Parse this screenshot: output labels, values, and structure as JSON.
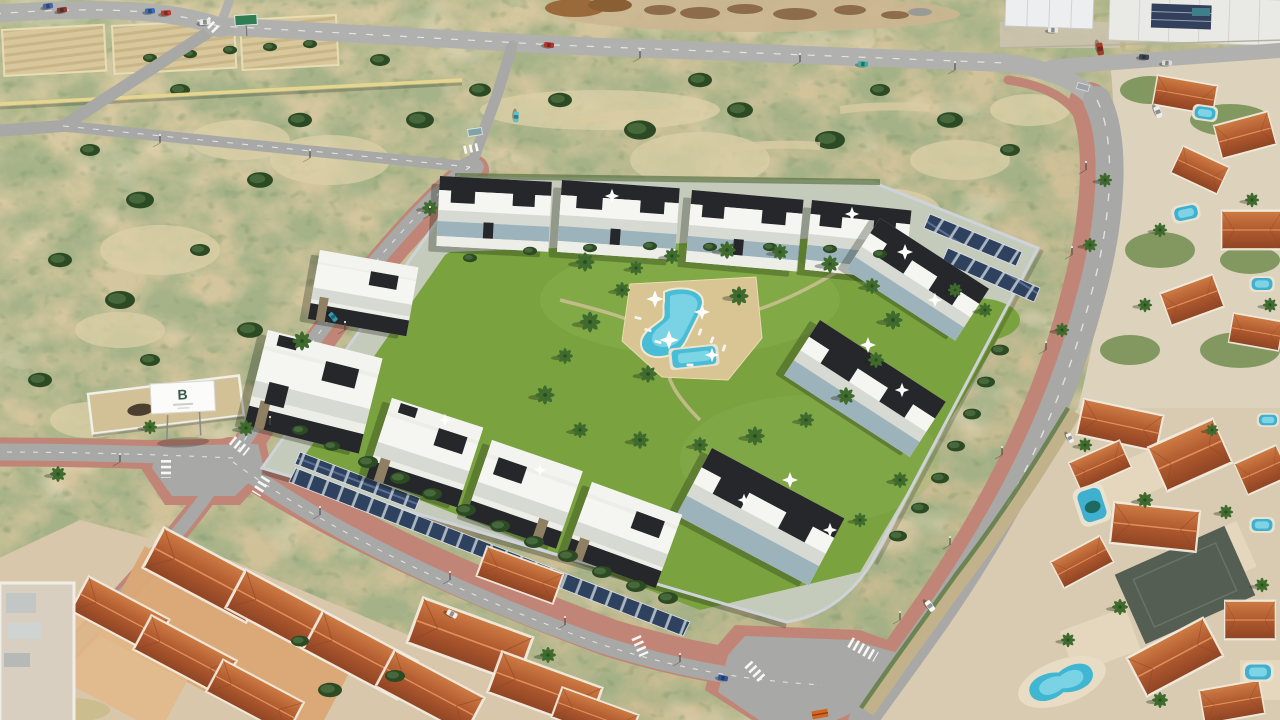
{
  "scene": {
    "type": "aerial-photograph",
    "description": "Aerial render of a modern Mediterranean apartment development with a central landscaped pool garden, bordered by new roads and scrubland plots, an established villa neighbourhood with private pools to the right and bottom-right, terracotta-roofed houses at the bottom-left, and industrial warehouses at the top right.",
    "billboard": {
      "logo_text": "B"
    },
    "palette": {
      "sand": "#d3c49c",
      "scrub_green": "#5d7340",
      "road_asphalt": "#a8a8a6",
      "road_markings": "#ffffff",
      "sidewalk_pink": "#c08577",
      "lawn_green": "#7aa23f",
      "pool_turquoise": "#49bdd6",
      "pool_deck_beige": "#d9c493",
      "building_white": "#edeee8",
      "building_dark": "#25272a",
      "solar_panel_blue": "#2e415f",
      "terracotta_roof": "#b0592f",
      "perimeter_wall_grey": "#cdd3d8",
      "villa_patio_tan": "#dba875"
    },
    "features": {
      "apartment_complex": {
        "blocks": 12,
        "central_pool": true,
        "kids_pool": true,
        "rooftop_sun_sails": true,
        "solar_carport_rows": 4,
        "perimeter_wall": true,
        "lawn_palms": true
      },
      "surroundings": {
        "scrubland_plots": true,
        "tilled_plots": 3,
        "terracotta_villa_clusters": 3,
        "warehouses_top_right": 2,
        "walled_enclosure": true,
        "billboard": true
      },
      "roads": {
        "pink_sidewalks": true,
        "crosswalks": 8,
        "street_lamps": true
      },
      "vehicles": {
        "cars": 16
      }
    }
  }
}
